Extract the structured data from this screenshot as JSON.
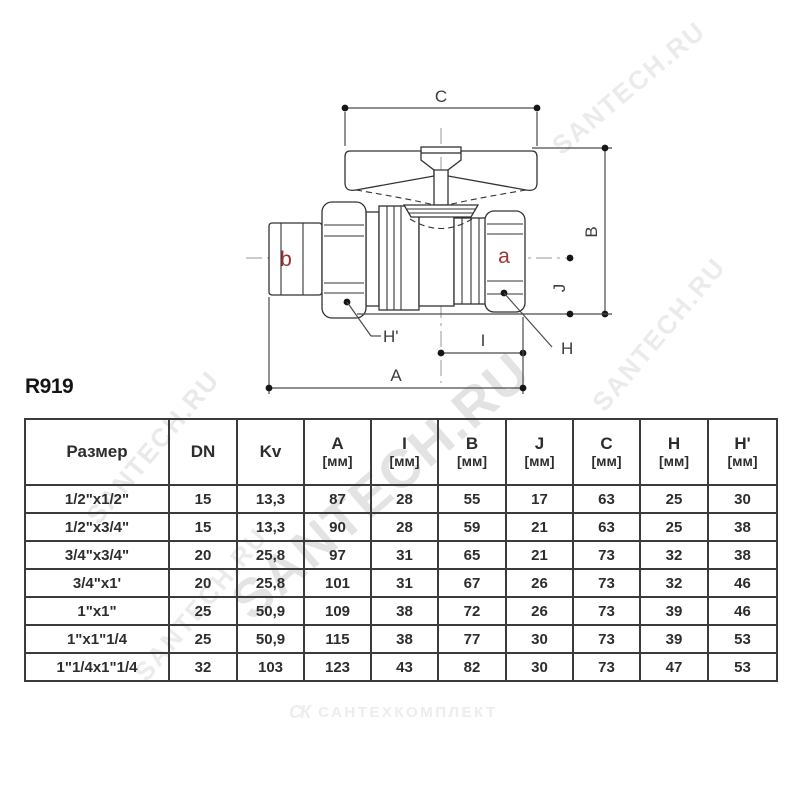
{
  "page": {
    "code": "R919"
  },
  "watermark": {
    "text": "SANTECH.RU",
    "default_color": "#e9e9e9",
    "tiles": [
      {
        "x": 240,
        "y": 578,
        "size": 54,
        "angle": -41,
        "color": "#e3e3e3"
      },
      {
        "x": 92,
        "y": 505,
        "size": 26,
        "angle": -50,
        "color": "#e9e9e9"
      },
      {
        "x": 140,
        "y": 662,
        "size": 26,
        "angle": -50,
        "color": "#ebebeb"
      },
      {
        "x": 556,
        "y": 134,
        "size": 26,
        "angle": -40,
        "color": "#ebebeb"
      },
      {
        "x": 598,
        "y": 392,
        "size": 26,
        "angle": -50,
        "color": "#ebebeb"
      }
    ]
  },
  "diagram": {
    "dims": {
      "c": "C",
      "b": "B",
      "j": "J",
      "h": "H",
      "h_prime": "H'",
      "i": "I",
      "a": "A"
    },
    "ports": {
      "a": {
        "label": "a",
        "color": "#a03232"
      },
      "b": {
        "label": "b",
        "color": "#993030"
      }
    }
  },
  "table": {
    "columns": [
      {
        "label": "Размер",
        "unit": ""
      },
      {
        "label": "DN",
        "unit": ""
      },
      {
        "label": "Kv",
        "unit": ""
      },
      {
        "label": "A",
        "unit": "[мм]"
      },
      {
        "label": "I",
        "unit": "[мм]"
      },
      {
        "label": "B",
        "unit": "[мм]"
      },
      {
        "label": "J",
        "unit": "[мм]"
      },
      {
        "label": "C",
        "unit": "[мм]"
      },
      {
        "label": "H",
        "unit": "[мм]"
      },
      {
        "label": "H'",
        "unit": "[мм]"
      }
    ],
    "rows": [
      [
        "1/2\"x1/2\"",
        "15",
        "13,3",
        "87",
        "28",
        "55",
        "17",
        "63",
        "25",
        "30"
      ],
      [
        "1/2\"x3/4\"",
        "15",
        "13,3",
        "90",
        "28",
        "59",
        "21",
        "63",
        "25",
        "38"
      ],
      [
        "3/4\"x3/4\"",
        "20",
        "25,8",
        "97",
        "31",
        "65",
        "21",
        "73",
        "32",
        "38"
      ],
      [
        "3/4\"x1'",
        "20",
        "25,8",
        "101",
        "31",
        "67",
        "26",
        "73",
        "32",
        "46"
      ],
      [
        "1\"x1\"",
        "25",
        "50,9",
        "109",
        "38",
        "72",
        "26",
        "73",
        "39",
        "46"
      ],
      [
        "1\"x1\"1/4",
        "25",
        "50,9",
        "115",
        "38",
        "77",
        "30",
        "73",
        "39",
        "53"
      ],
      [
        "1\"1/4x1\"1/4",
        "32",
        "103",
        "123",
        "43",
        "82",
        "30",
        "73",
        "47",
        "53"
      ]
    ]
  },
  "footer": {
    "logo_mark": "СК",
    "logo_text": "САНТЕХКОМПЛЕКТ",
    "color": "#ededed"
  }
}
